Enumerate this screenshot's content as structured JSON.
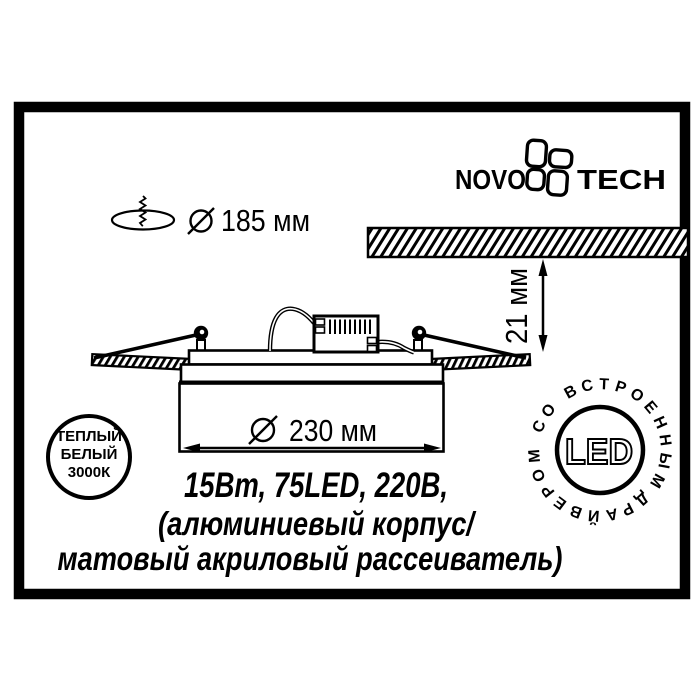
{
  "colors": {
    "ink": "#000000",
    "paper": "#ffffff"
  },
  "logo": {
    "name_left": "NOVO",
    "name_right": "TECH",
    "icon": "novotech-flower-icon"
  },
  "hole_spec": {
    "icon": "screw-in-ceiling-hole-icon",
    "diameter_icon": "diameter-symbol",
    "value": "185 мм"
  },
  "recess_depth": {
    "value": "21 мм"
  },
  "fixture_diameter": {
    "diameter_icon": "diameter-symbol",
    "value": "230 мм"
  },
  "warm_white_badge": {
    "line1": "ТЕПЛЫЙ",
    "line2": "БЕЛЫЙ",
    "line3": "3000К"
  },
  "led_badge": {
    "center": "LED",
    "ring": "ДРАЙВЕРОМ СО ВСТРОЕННЫМ"
  },
  "specs": {
    "line1": "15Вт, 75LED, 220В,",
    "line2": "(алюминиевый корпус/",
    "line3": "матовый акриловый рассеиватель)"
  }
}
